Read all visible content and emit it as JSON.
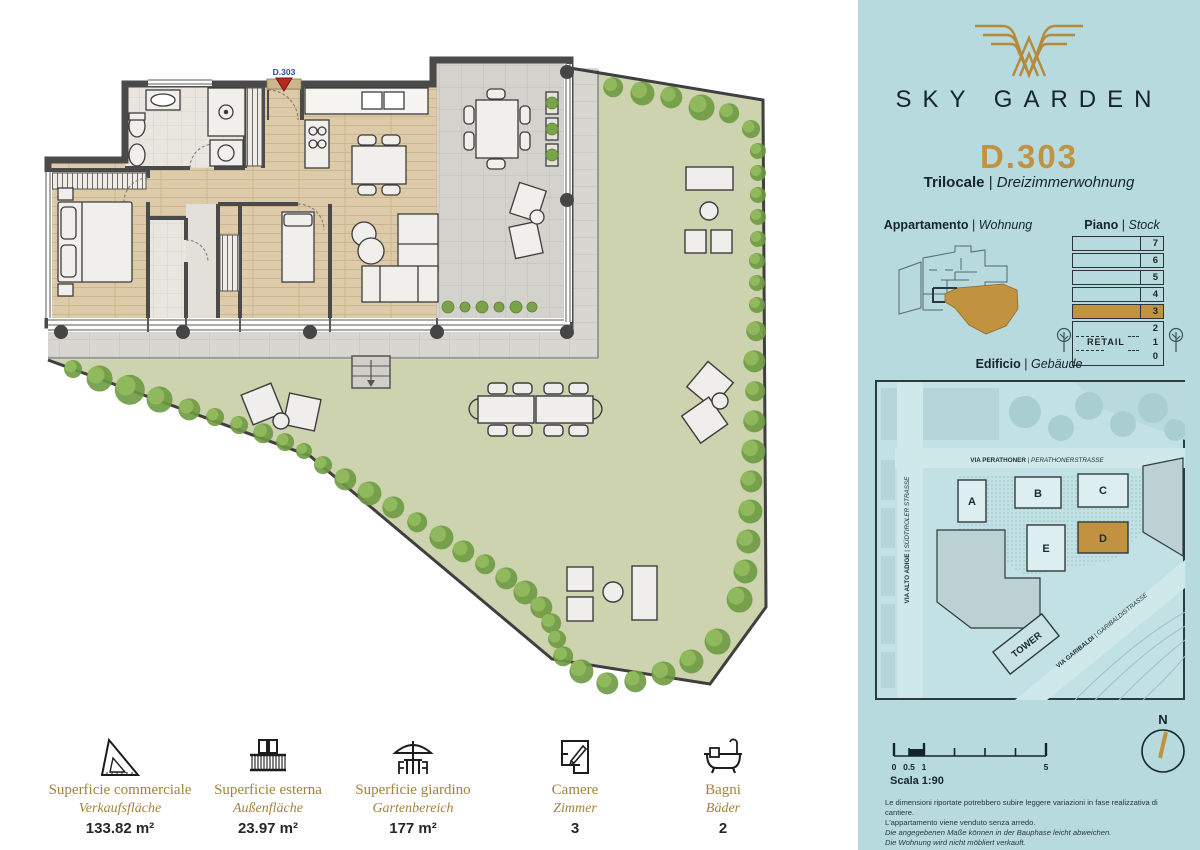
{
  "sep": "|",
  "plan": {
    "marker": "D.303"
  },
  "sidebar": {
    "brand_name": "SKY GARDEN",
    "unit": {
      "code": "D.303",
      "type_it": "Trilocale",
      "type_de": "Dreizimmerwohnung"
    },
    "apartment_label": {
      "it": "Appartamento",
      "de": "Wohnung"
    },
    "piano_label": {
      "it": "Piano",
      "de": "Stock"
    },
    "edificio_label": {
      "it": "Edificio",
      "de": "Gebäude"
    },
    "floors": {
      "rows": [
        "7",
        "6",
        "5",
        "4",
        "3",
        "2",
        "1",
        "0"
      ],
      "highlighted": "3",
      "retail": "RETAIL"
    },
    "site": {
      "street1_it": "VIA PERATHONER",
      "street1_de": "PERATHONERSTRASSE",
      "street2_it": "VIA ALTO ADIGE",
      "street2_de": "SÜDTIROLER STRASSE",
      "street3_it": "VIA GARIBALDI",
      "street3_de": "GARIBALDISTRASSE",
      "buildings": [
        "A",
        "B",
        "C",
        "D",
        "E"
      ],
      "highlighted_building": "D",
      "tower": "TOWER"
    },
    "scale": {
      "t0": "0",
      "t05": "0.5",
      "t1": "1",
      "t5": "5",
      "label": "Scala 1:90"
    },
    "north": "N",
    "disclaimer": [
      "Le dimensioni riportate potrebbero subire leggere variazioni in fase realizzativa di cantiere.",
      "L'appartamento viene venduto senza arredo.",
      "Die angegebenen Maße können in der Bauphase leicht abweichen.",
      "Die Wohnung wird nicht möbliert verkauft."
    ]
  },
  "stats": [
    {
      "icon": "set-square-icon",
      "label_it": "Superficie commerciale",
      "label_de": "Verkaufsfläche",
      "value": "133.82 m²"
    },
    {
      "icon": "balcony-icon",
      "label_it": "Superficie esterna",
      "label_de": "Außenfläche",
      "value": "23.97 m²"
    },
    {
      "icon": "garden-table-icon",
      "label_it": "Superficie giardino",
      "label_de": "Gartenbereich",
      "value": "177 m²"
    },
    {
      "icon": "rooms-plan-icon",
      "label_it": "Camere",
      "label_de": "Zimmer",
      "value": "3"
    },
    {
      "icon": "bathtub-icon",
      "label_it": "Bagni",
      "label_de": "Bäder",
      "value": "2"
    }
  ],
  "colors": {
    "accent_gold": "#c19340",
    "sidebar_teal": "#b6dade",
    "garden_green": "#ccd3ae",
    "wall_gray": "#4a4a4a"
  }
}
